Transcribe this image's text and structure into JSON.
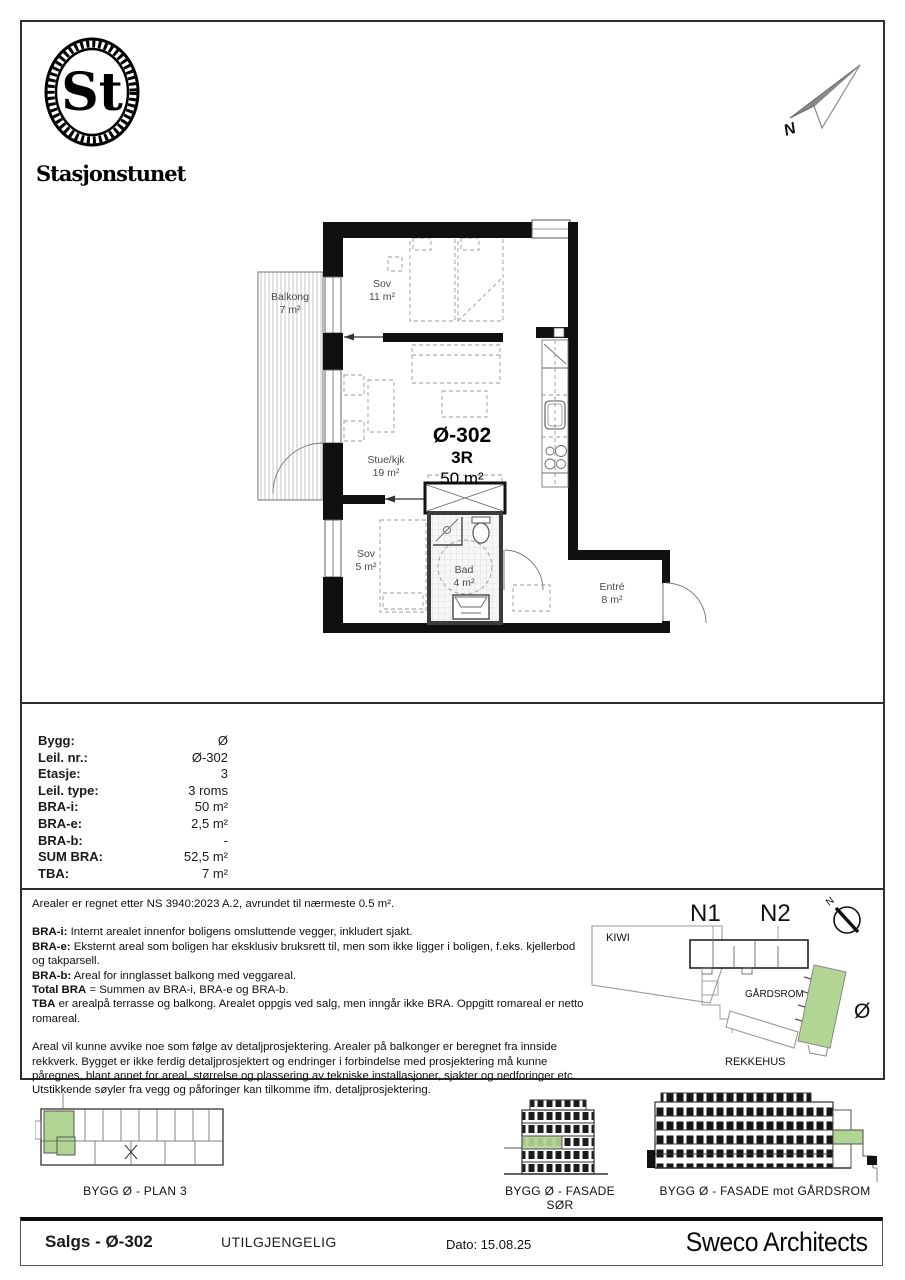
{
  "logo": {
    "monogram": "St",
    "name": "Stasjonstunet"
  },
  "compass": {
    "north": "N"
  },
  "plan": {
    "unit_label": "Ø-302",
    "rooms_label": "3R",
    "area_label": "50 m²",
    "rooms": [
      {
        "name": "Balkong",
        "area": "7 m²"
      },
      {
        "name": "Sov",
        "area": "11 m²"
      },
      {
        "name": "Stue/kjk",
        "area": "19 m²"
      },
      {
        "name": "Sov",
        "area": "5 m²"
      },
      {
        "name": "Bad",
        "area": "4 m²"
      },
      {
        "name": "Entré",
        "area": "8 m²"
      }
    ]
  },
  "info_table": {
    "rows": [
      {
        "label": "Bygg:",
        "value": "Ø"
      },
      {
        "label": "Leil. nr.:",
        "value": "Ø-302"
      },
      {
        "label": "Etasje:",
        "value": "3"
      },
      {
        "label": "Leil. type:",
        "value": "3 roms"
      },
      {
        "label": "BRA-i:",
        "value": "50 m²"
      },
      {
        "label": "BRA-e:",
        "value": "2,5 m²"
      },
      {
        "label": "BRA-b:",
        "value": "-"
      },
      {
        "label": "SUM BRA:",
        "value": "52,5 m²"
      },
      {
        "label": "TBA:",
        "value": "7 m²"
      }
    ]
  },
  "notes": {
    "intro": "Arealer er regnet etter NS 3940:2023 A.2, avrundet til nærmeste 0.5 m².",
    "definitions": [
      {
        "term": "BRA-i:",
        "text": "Internt arealet innenfor boligens omsluttende vegger, inkludert sjakt."
      },
      {
        "term": "BRA-e:",
        "text": "Eksternt areal som boligen har eksklusiv bruksrett til, men som ikke ligger i boligen, f.eks. kjellerbod og takparsell."
      },
      {
        "term": "BRA-b:",
        "text": "Areal for innglasset balkong med veggareal."
      },
      {
        "term": "Total BRA",
        "text": "= Summen av BRA-i, BRA-e og BRA-b."
      },
      {
        "term": "TBA",
        "text": "er arealpå terrasse og balkong. Arealet oppgis ved salg, men inngår ikke BRA. Oppgitt romareal er netto romareal."
      }
    ],
    "disclaimer": "Areal vil kunne avvike noe som følge av detaljprosjektering. Arealer på balkonger er beregnet fra innside rekkverk. Bygget er ikke ferdig detaljprosjektert og endringer i forbindelse med prosjektering må kunne påregnes, blant annet for areal, størrelse og plassering av tekniske installasjoner, sjakter og nedforinger etc. Utstikkende søyler fra vegg og påforinger kan tilkomme ifm. detaljprosjektering."
  },
  "site_plan": {
    "n1": "N1",
    "n2": "N2",
    "kiwi": "KIWI",
    "gardsrom": "GÅRDSROM",
    "rekkehus": "REKKEHUS",
    "building": "Ø",
    "north": "N",
    "highlight_color": "#b2d593"
  },
  "diagrams": [
    {
      "label": "BYGG Ø - PLAN 3"
    },
    {
      "label": "BYGG Ø - FASADE SØR"
    },
    {
      "label": "BYGG Ø - FASADE mot GÅRDSROM"
    }
  ],
  "footer": {
    "sales_id": "Salgs - Ø-302",
    "status": "UTILGJENGELIG",
    "date": "Dato: 15.08.25",
    "architect": "Sweco Architects"
  }
}
